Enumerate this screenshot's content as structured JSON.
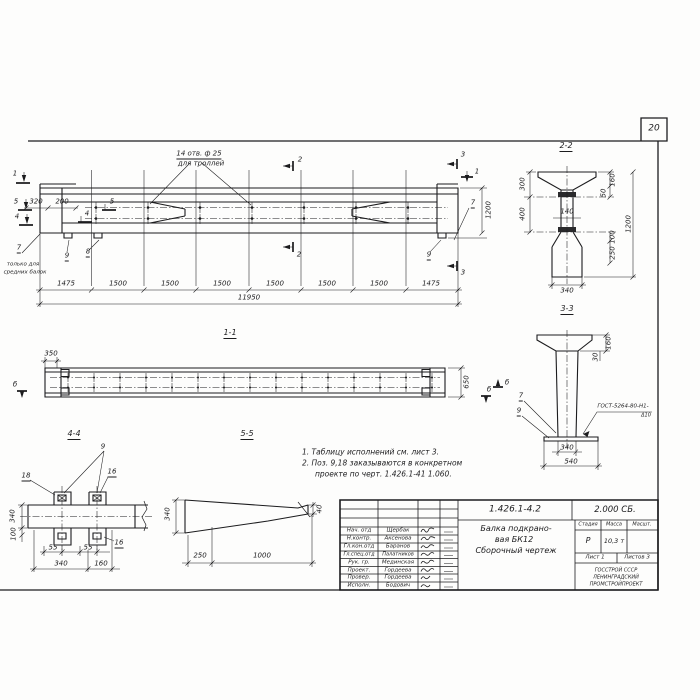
{
  "page_number": "20",
  "elevation": {
    "hole_note_1": "14 отв. ф 25",
    "hole_note_2": "для троллей",
    "cut_1_left": "1",
    "cut_5_left": "5",
    "cut_4_left": "4",
    "cut_2_top": "2",
    "cut_2_bottom": "2",
    "cut_3_top": "3",
    "cut_3_bottom": "3",
    "cut_1_right": "1",
    "web_mark_5": "5",
    "web_mark_4": "4",
    "dim_320": "320",
    "dim_200": "200",
    "mark_7_left": "7",
    "left_note_1": "только для",
    "left_note_2": "средних балок",
    "mark_9_left": "9",
    "mark_8_left": "8",
    "mark_9_right": "9",
    "mark_7_right": "7",
    "dim_1200": "1200",
    "bottom_dims": [
      "1475",
      "1500",
      "1500",
      "1500",
      "1500",
      "1500",
      "1500",
      "1475"
    ],
    "dim_total": "11950"
  },
  "section_1_1": {
    "title": "1-1",
    "dim_350": "350",
    "dim_650": "650",
    "view_mark_left": "б",
    "view_mark_right": "б"
  },
  "section_2_2": {
    "title": "2-2",
    "dim_300": "300",
    "dim_400": "400",
    "dim_140": "140",
    "dim_160": "160",
    "dim_50": "50",
    "dim_1200": "1200",
    "dim_100": "100",
    "dim_250": "250",
    "dim_340": "340"
  },
  "section_3_3": {
    "title": "3-3",
    "dim_160": "160",
    "dim_30": "30",
    "dim_340": "340",
    "dim_540": "540",
    "mark_7": "7",
    "mark_9": "9",
    "weld_note_1": "ГОСТ-5264-80-Н1-",
    "weld_note_2": "Δ10",
    "view_mark": "б"
  },
  "section_4_4": {
    "title": "4-4",
    "mark_9": "9",
    "mark_18": "18",
    "mark_16_top": "16",
    "mark_16_bottom": "16",
    "dim_340_left": "340",
    "dim_100": "100",
    "dim_55_1": "55",
    "dim_55_2": "55",
    "dim_340_bottom": "340",
    "dim_160": "160"
  },
  "section_5_5": {
    "title": "5-5",
    "dim_340": "340",
    "dim_40": "40",
    "dim_250": "250",
    "dim_1000": "1000"
  },
  "notes": {
    "line1": "1. Таблицу исполнений см. лист 3.",
    "line2": "2. Поз. 9,18 заказываются в конкретном",
    "line3": "проекте по черт. 1.426.1-41 1.060."
  },
  "title_block": {
    "doc_number": "1.426.1-4.2",
    "doc_code": "2.000 СБ.",
    "title_line1": "Балка подкрано-",
    "title_line2": "вая БК12",
    "title_line3": "Сборочный чертеж",
    "col_stage": "Стадия",
    "col_mass": "Масса",
    "col_scale": "Масшт.",
    "stage": "Р",
    "mass": "10,3 т",
    "scale": "",
    "sheet": "Лист 1",
    "sheets": "Листов 3",
    "org_line1": "ГОССТРОЙ СССР",
    "org_line2": "ЛЕНИНГРАДСКИЙ",
    "org_line3": "ПРОМСТРОЙПРОЕКТ",
    "staff": [
      {
        "role": "Нач. отд",
        "name": "Щербак"
      },
      {
        "role": "Н.контр.",
        "name": "Аксенова"
      },
      {
        "role": "Гл.кон.отд",
        "name": "Баранов"
      },
      {
        "role": "Гл.спец.отд",
        "name": "Палатников"
      },
      {
        "role": "Рук. гр.",
        "name": "Мединская"
      },
      {
        "role": "Проект.",
        "name": "Гордеева"
      },
      {
        "role": "Провер.",
        "name": "Гордеева"
      },
      {
        "role": "Исполн.",
        "name": "Бодович"
      }
    ]
  }
}
